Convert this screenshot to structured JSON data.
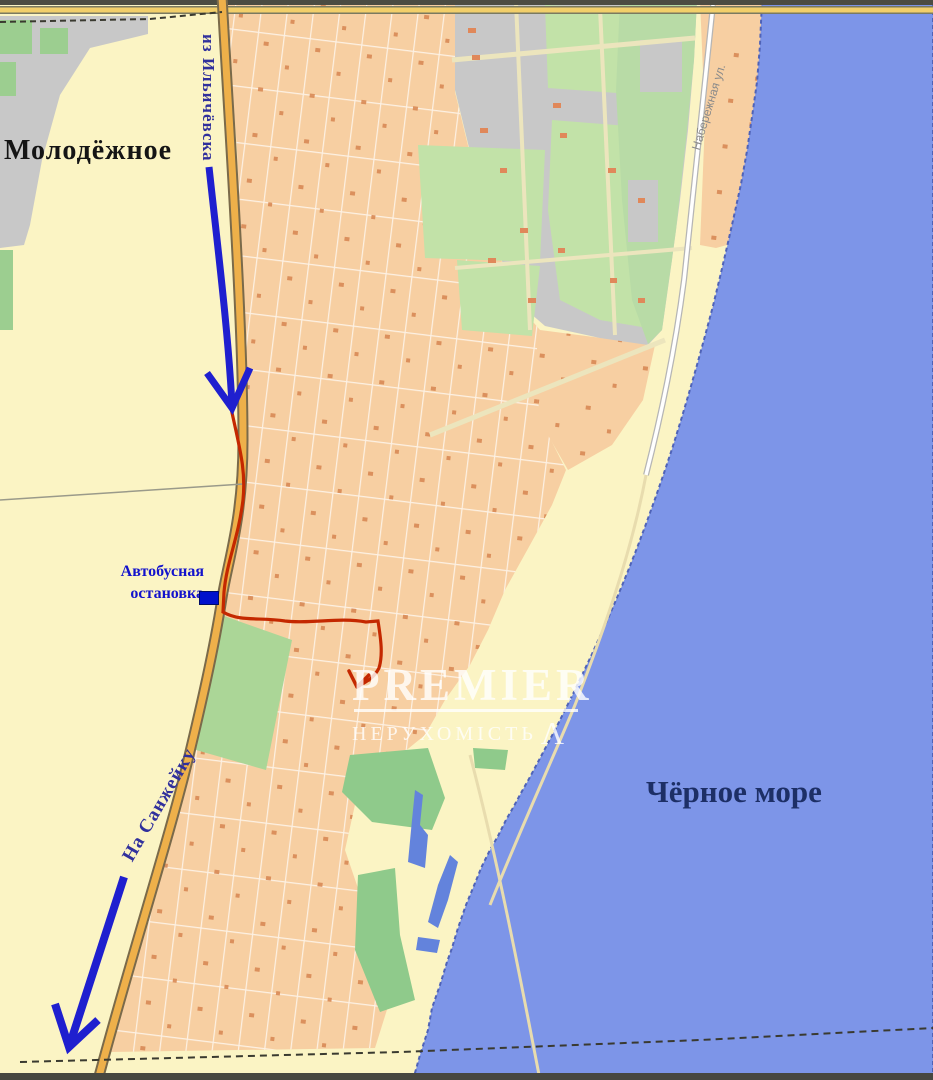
{
  "map": {
    "labels": {
      "settlement": "Молодёжное",
      "sea": "Чёрное море",
      "from_road": "из Ильичёвска",
      "to_road": "На Санжейку",
      "embankment_street": "Набережная ул.",
      "bus_stop_line1": "Автобусная",
      "bus_stop_line2": "остановка"
    },
    "watermark": {
      "brand": "PREMIER",
      "subtitle": "НЕРУХОМІСТЬ",
      "mark": "Λ"
    },
    "colors": {
      "sea": "#7d95e8",
      "land": "#fbf4c4",
      "residential": "#f7cfa2",
      "industrial": "#c8c8c8",
      "park_green": "#8fca8b",
      "block_green": "#c2e2a8",
      "pond_blue": "#6383dc",
      "road_yellow": "#eeb04a",
      "route_red": "#c42800",
      "arrow_blue": "#1f1fcf",
      "bus_stop_blue": "#1212cc",
      "sea_label_navy": "#1d2f66"
    }
  }
}
